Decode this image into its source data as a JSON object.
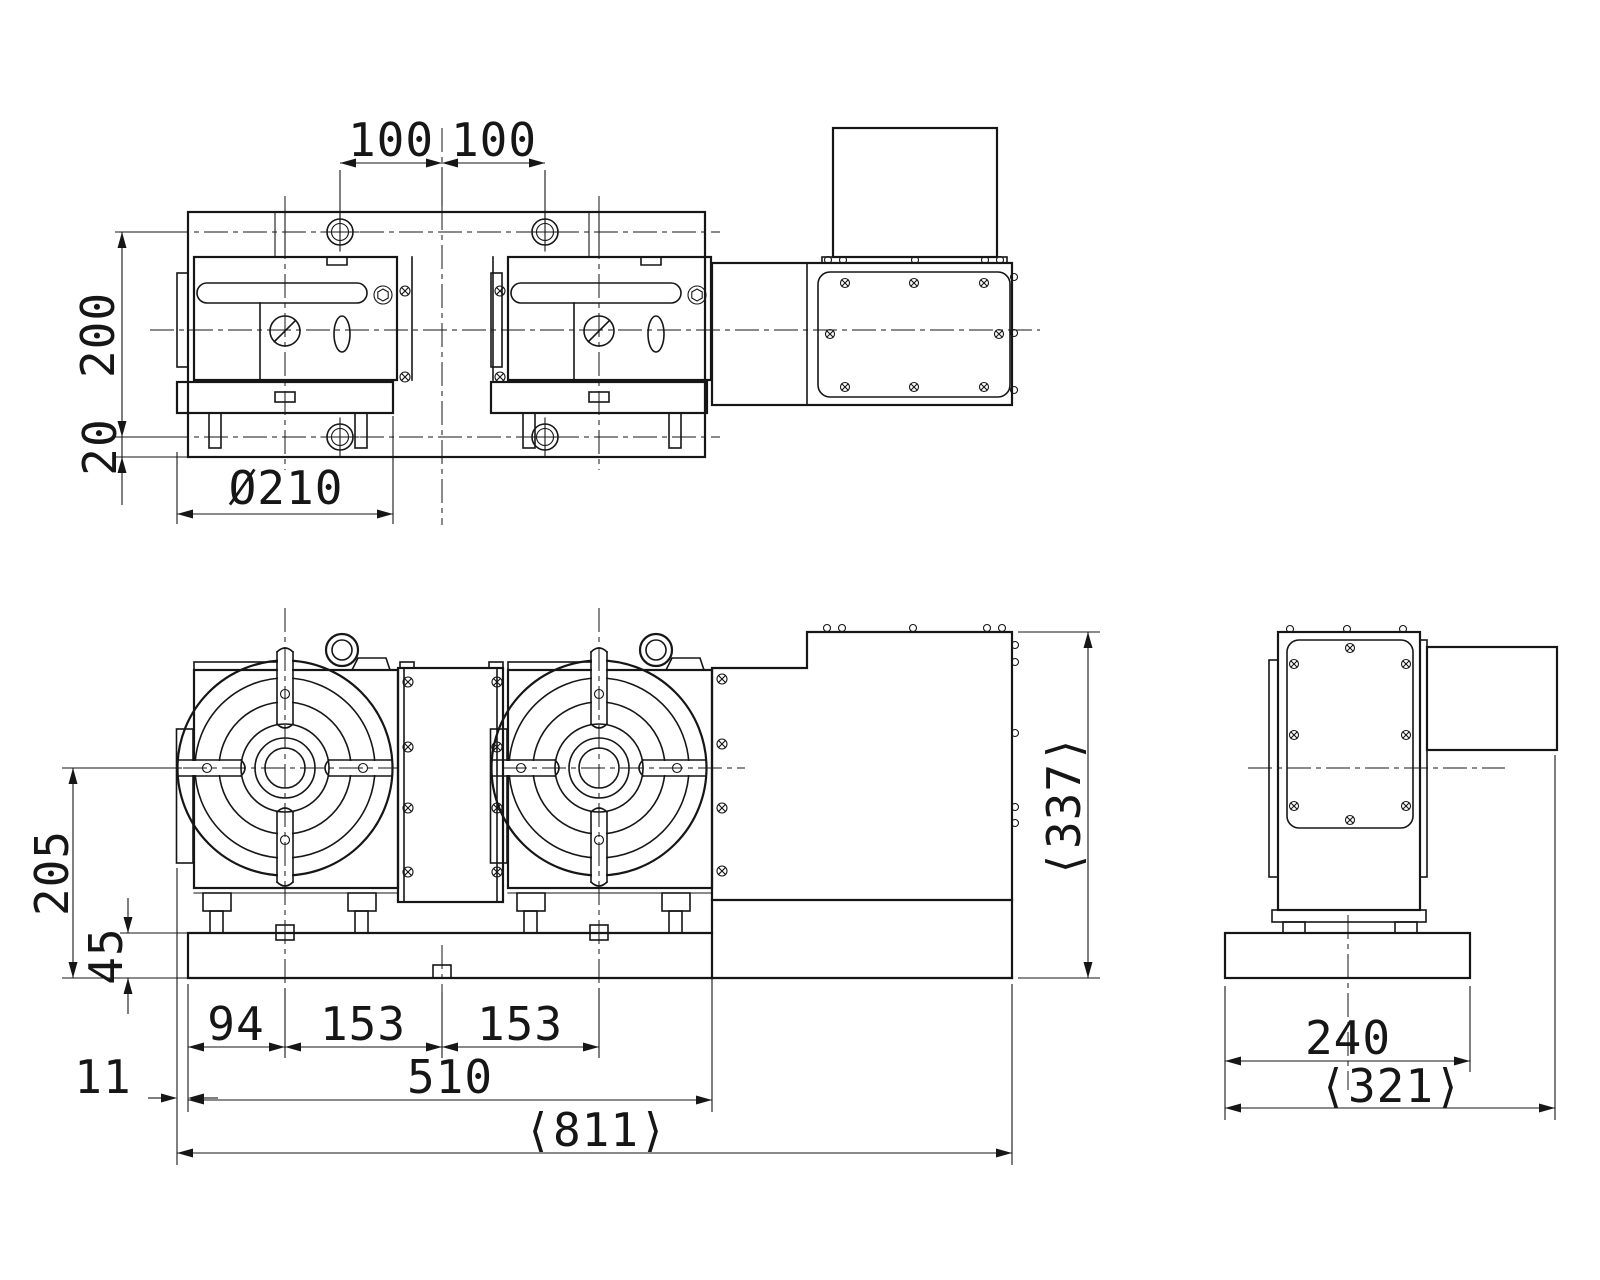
{
  "dims": {
    "top_pitch_left": "100",
    "top_pitch_right": "100",
    "top_depth": "200",
    "top_offset": "20",
    "table_diameter": "Ø210",
    "center_height": "205",
    "base_thickness": "45",
    "edge_to_first_center": "94",
    "first_to_mid": "153",
    "mid_to_second": "153",
    "body_width": "510",
    "overall_width": "⟨811⟩",
    "table_overhang": "11",
    "overall_height": "⟨337⟩",
    "side_base_width": "240",
    "side_overall_depth": "⟨321⟩"
  }
}
